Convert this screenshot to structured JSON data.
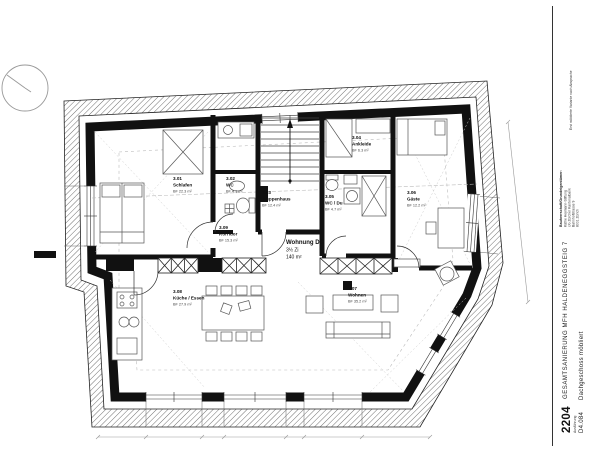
{
  "plan": {
    "apartment": {
      "name": "Wohnung DG",
      "size": "3½ Zi",
      "area": "140 m²"
    },
    "rooms": [
      {
        "number": "3.01",
        "name": "Schlafen",
        "area": "BF 22.3 m²"
      },
      {
        "number": "3.02",
        "name": "WC",
        "area": "BF 4.1 m²"
      },
      {
        "number": "3.03",
        "name": "Treppenhaus",
        "area": "BF 12.4 m²"
      },
      {
        "number": "3.04",
        "name": "Ankleide",
        "area": "BF 6.3 m²"
      },
      {
        "number": "3.05",
        "name": "WC / Du",
        "area": "BF 4.7 m²"
      },
      {
        "number": "3.06",
        "name": "Gäste",
        "area": "BF 12.2 m²"
      },
      {
        "number": "3.07",
        "name": "Wohnen",
        "area": "BF 35.2 m²"
      },
      {
        "number": "3.08",
        "name": "Küche / Essen",
        "area": "BF 27.9 m²"
      },
      {
        "number": "3.09",
        "name": "Korridor",
        "area": "BF 15.3 m²"
      }
    ]
  },
  "title_block": {
    "project_number": "2204",
    "project_number_caption": "Ausführung",
    "project_name": "GESAMTSANIERUNG MFH HALDENEGGSTEIG 7",
    "plan_number": "D4.084",
    "plan_title": "Dachgeschoss möbliert",
    "client_heading": "Bauherrschaft/Grundeigentümer:",
    "client_lines": [
      "Käthe Heymann-Stiftung",
      "c/o Zürcher Kantonalbank",
      "Bahnhofstrasse 9",
      "8001 Zürich"
    ],
    "note": "Erst möblierte Variante nach Absprache"
  },
  "colors": {
    "ink": "#111111",
    "light_line": "#bbbbbb",
    "hatch": "#333333"
  }
}
